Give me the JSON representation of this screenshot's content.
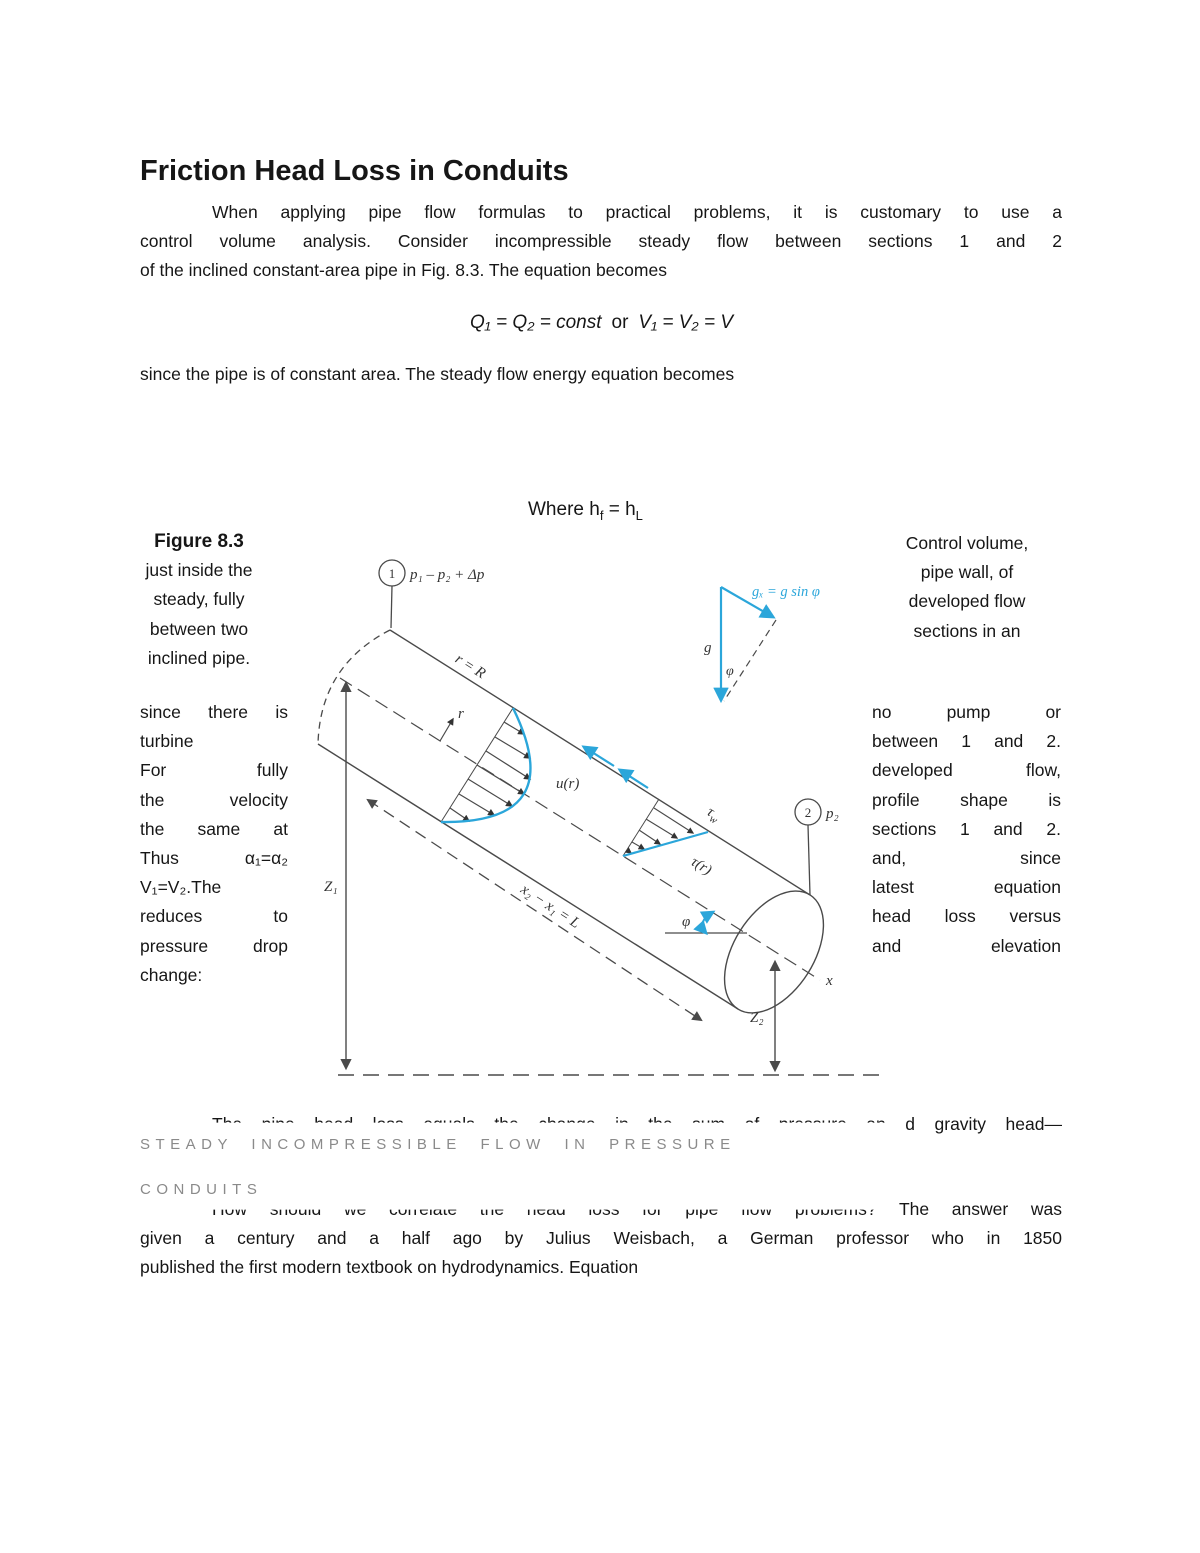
{
  "page": {
    "title": "Friction Head Loss in Conduits",
    "intro_lines": [
      "When applying pipe flow formulas to practical problems, it is customary to use a",
      "control volume analysis. Consider incompressible steady flow between sections 1 and 2",
      "of the inclined constant-area pipe in Fig. 8.3. The equation becomes"
    ],
    "equation": {
      "lhs": "Q₁ = Q₂ = const",
      "mid": "or",
      "rhs": "V₁ = V₂ = V"
    },
    "para2": "since the pipe is of constant area. The steady flow energy equation becomes",
    "where": {
      "a": "Where h",
      "sub1": "f",
      "b": " = h",
      "sub2": "L"
    }
  },
  "figure": {
    "caption_left": [
      "Figure 8.3",
      "just inside the",
      "steady, fully",
      "between two",
      "inclined pipe."
    ],
    "caption_right": [
      "Control volume,",
      "pipe wall, of",
      "developed flow",
      "sections in an"
    ],
    "left_lines": [
      [
        "since",
        "there",
        "is"
      ],
      [
        "turbine"
      ],
      [
        "For",
        "fully"
      ],
      [
        "the",
        "velocity"
      ],
      [
        "the",
        "same",
        "at"
      ],
      [
        "Thus",
        "α₁=α₂"
      ],
      [
        "V₁=V₂.The"
      ],
      [
        "reduces",
        "to"
      ],
      [
        "pressure",
        "drop"
      ],
      [
        "change:"
      ]
    ],
    "right_lines": [
      [
        "no",
        "pump",
        "or"
      ],
      [
        "between",
        "1",
        "and",
        "2."
      ],
      [
        "developed",
        "flow,"
      ],
      [
        "profile",
        "shape",
        "is"
      ],
      [
        "sections",
        "1",
        "and",
        "2."
      ],
      [
        "and,",
        "since"
      ],
      [
        "latest",
        "equation"
      ],
      [
        "head",
        "loss",
        "versus"
      ],
      [
        "and",
        "elevation"
      ]
    ],
    "labels": {
      "section1": "1",
      "section2": "2",
      "p1": "p₁ – p₂ + Δp",
      "p2": "p₂",
      "rR": "r = R",
      "r": "r",
      "ur": "u(r)",
      "tau": "τ",
      "tau_sub": "w",
      "tau_r": "τ(r)",
      "phi": "φ",
      "phi2": "φ",
      "g": "g",
      "gx": "gₓ = g sin φ",
      "x": "x",
      "z1": "Z₁",
      "z2": "Z₂",
      "length": "x₂ − x₁ = L"
    }
  },
  "bottom": {
    "line1_clipped": "The pipe head loss equals the change in the sum of pressure an",
    "line1_visible": "d gravity head—",
    "heading_line1": "STEADY INCOMPRESSIBLE FLOW IN PRESSURE",
    "heading_line2": "CONDUITS",
    "line3_clipped": "How should we correlate the head loss for pipe flow problems? ",
    "line3_visible": "The answer was",
    "line4": "given a century and a half ago by Julius Weisbach, a German professor who in 1850",
    "line5": "published the first modern textbook on hydrodynamics. Equation"
  },
  "colors": {
    "accent_blue": "#2ba6da",
    "heading_gray": "#8a8a8a"
  }
}
